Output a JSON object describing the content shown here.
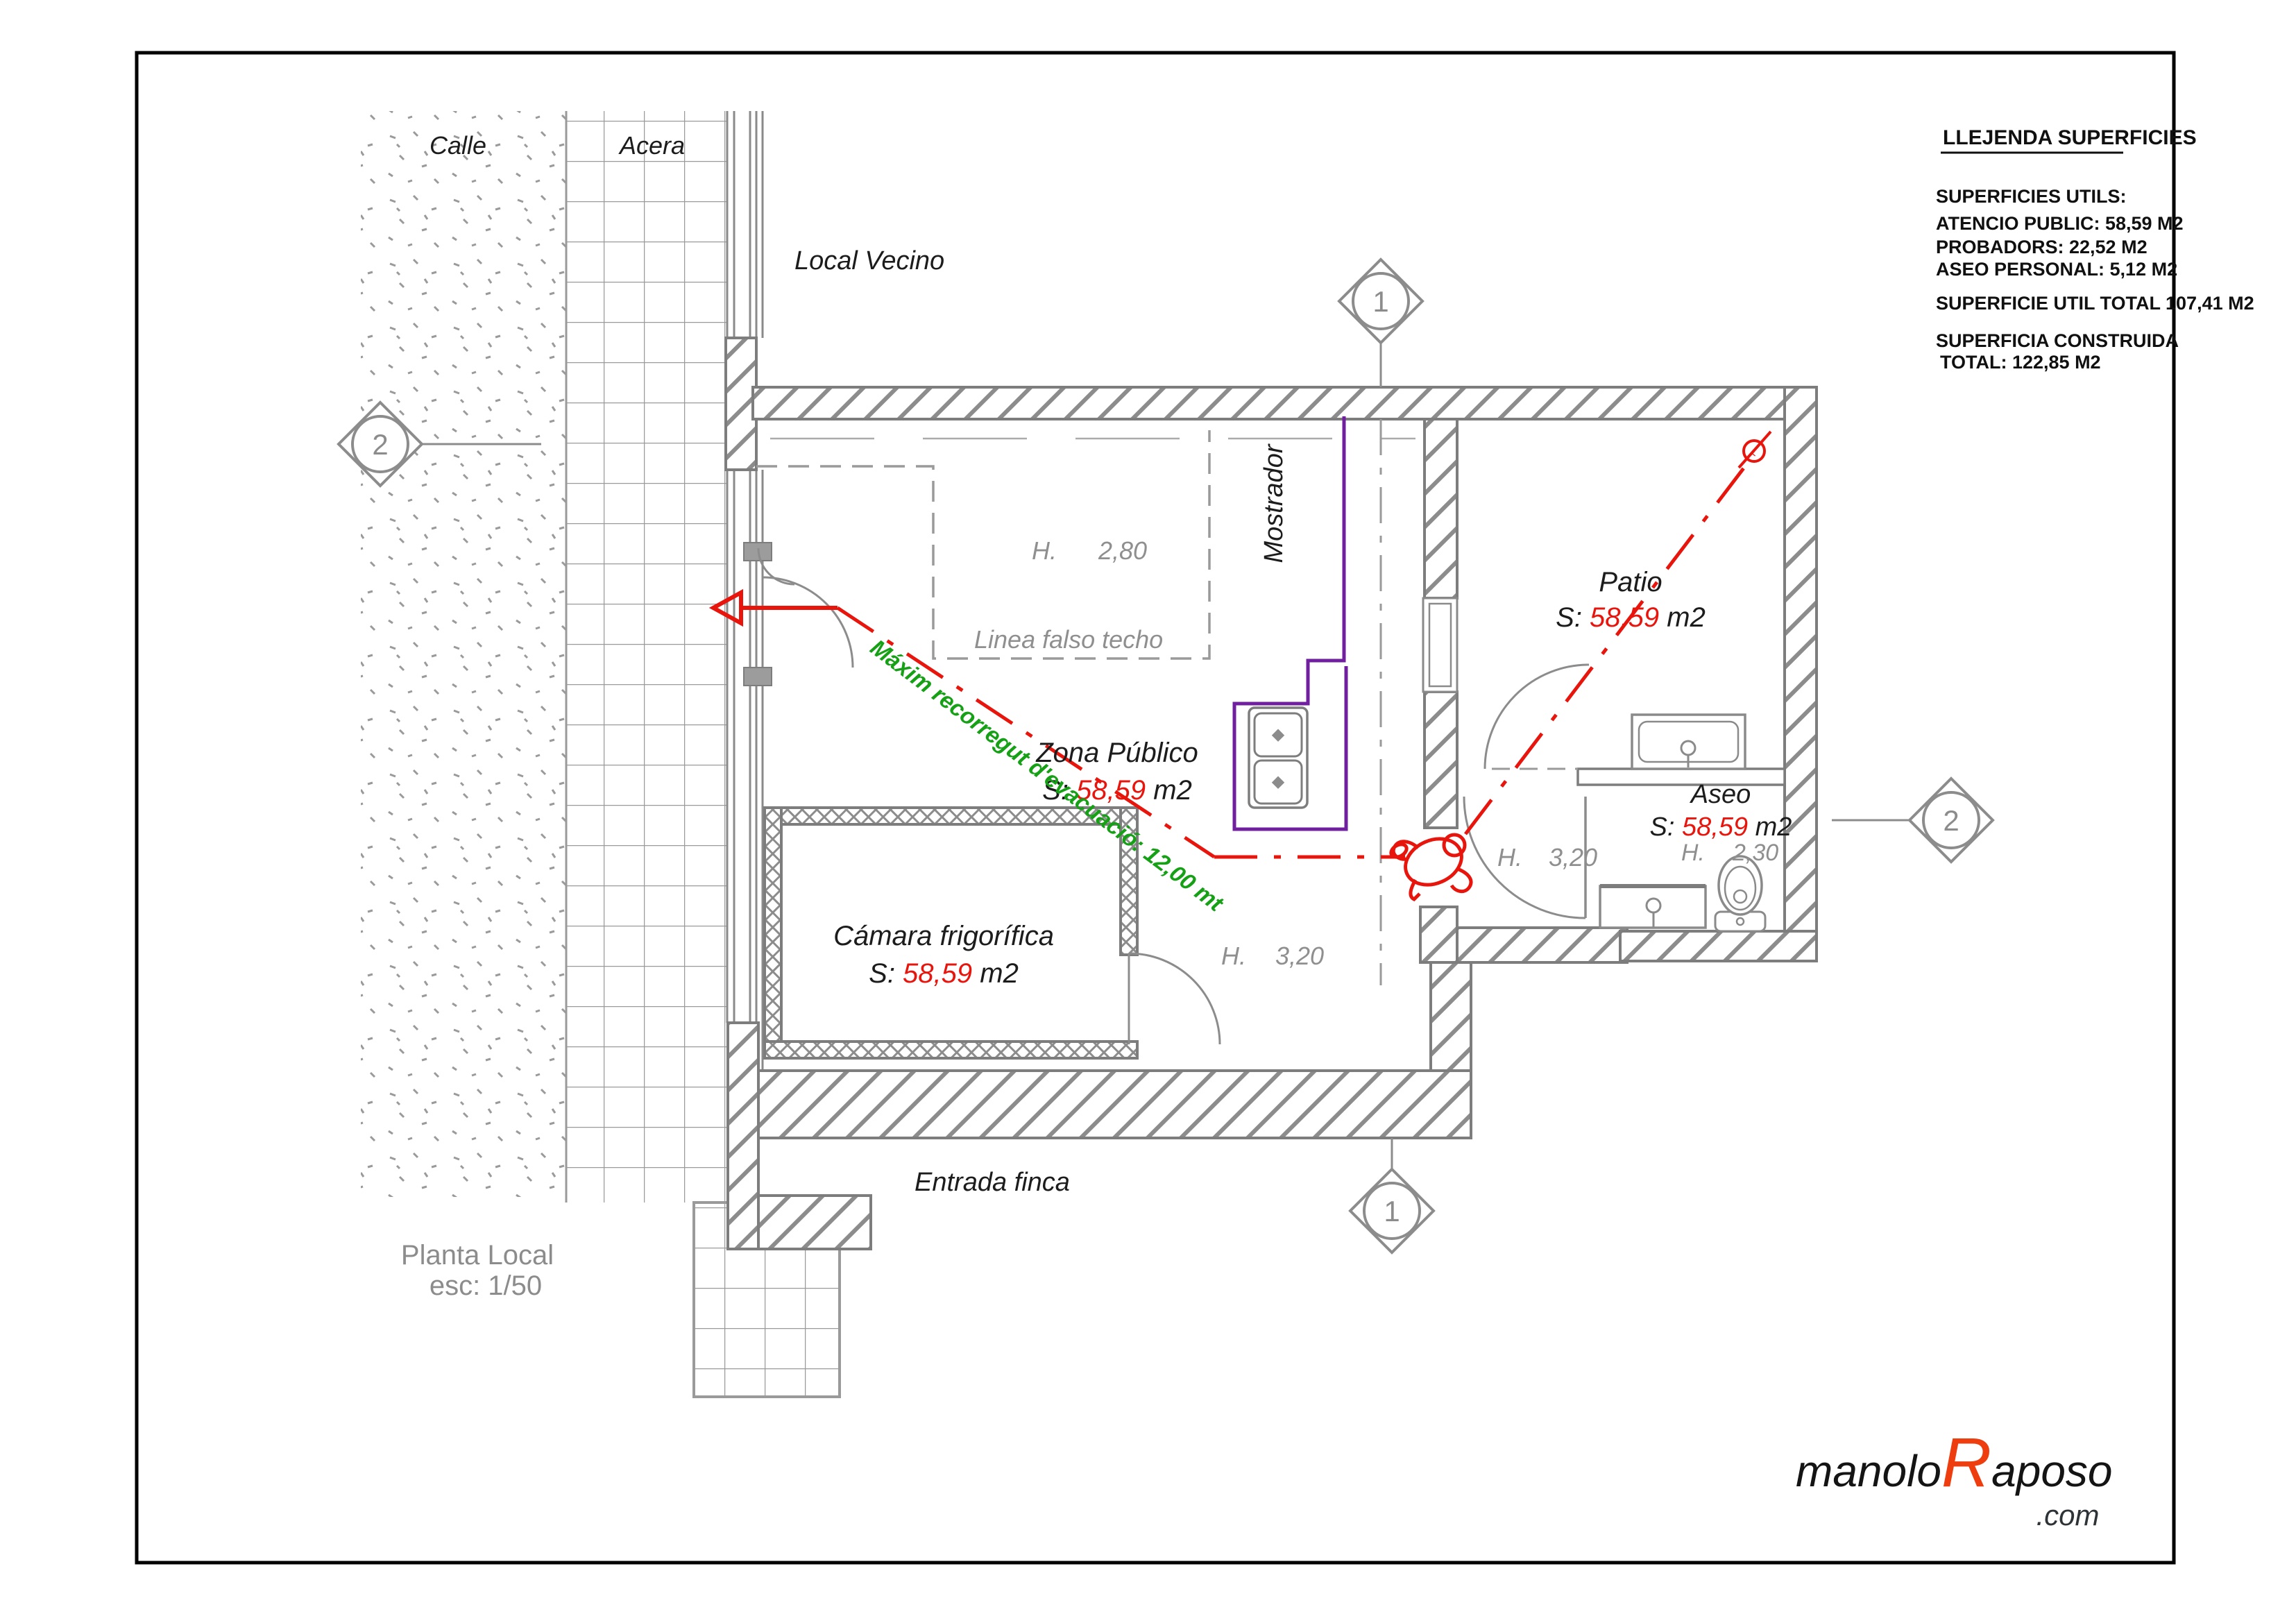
{
  "drawing": {
    "plan_title": "Planta Local",
    "plan_scale": "esc: 1/50",
    "legend": {
      "title": "LLEJENDA  SUPERFICIES",
      "superficies_utils": "SUPERFICIES UTILS:",
      "atencio_public": "ATENCIO PUBLIC:  58,59  M2",
      "probadors": "PROBADORS: 22,52 M2",
      "aseo_personal": "ASEO PERSONAL: 5,12 M2",
      "superficie_util_total": "SUPERFICIE UTIL TOTAL 107,41 M2",
      "superficia_construida": "SUPERFICIA CONSTRUIDA",
      "total": "TOTAL: 122,85 M2"
    },
    "labels": {
      "calle": "Calle",
      "acera": "Acera",
      "local_vecino": "Local Vecino",
      "entrada_finca": "Entrada finca",
      "mostrador": "Mostrador",
      "linea_falso_techo": "Linea falso techo",
      "h_falso_techo": {
        "label": "H.",
        "value": "2,80"
      },
      "h_zona": {
        "label": "H.",
        "value": "3,20"
      },
      "h_pasillo": {
        "label": "H.",
        "value": "3,20"
      },
      "h_aseo": {
        "label": "H.",
        "value": "2,30"
      }
    },
    "rooms": {
      "zona_publico": {
        "name": "Zona Público",
        "s_label": "S: ",
        "s_value": "58,59",
        "s_unit": " m2"
      },
      "camara": {
        "name": "Cámara frigorífica",
        "s_label": "S: ",
        "s_value": "58,59",
        "s_unit": " m2"
      },
      "patio": {
        "name": "Patio",
        "s_label": "S: ",
        "s_value": "58,59",
        "s_unit": " m2"
      },
      "aseo": {
        "name": "Aseo",
        "s_label": "S: ",
        "s_value": "58,59",
        "s_unit": " m2"
      }
    },
    "evacuation_note": "Máxim recorregut d'evacuació:  12,00 mt",
    "markers": {
      "section_1": "1",
      "section_2": "2"
    },
    "logo": {
      "part1": "manolo",
      "part2": "R",
      "part3": "aposo",
      "tld": ".com"
    },
    "colors": {
      "red": "#e8150d",
      "green": "#16a016",
      "purple": "#70209f",
      "wall_gray": "#7d7d7d",
      "hatch_gray": "#8c8c8c",
      "text_gray": "#8f8f8f",
      "logo_orange": "#ee3d0f"
    }
  }
}
